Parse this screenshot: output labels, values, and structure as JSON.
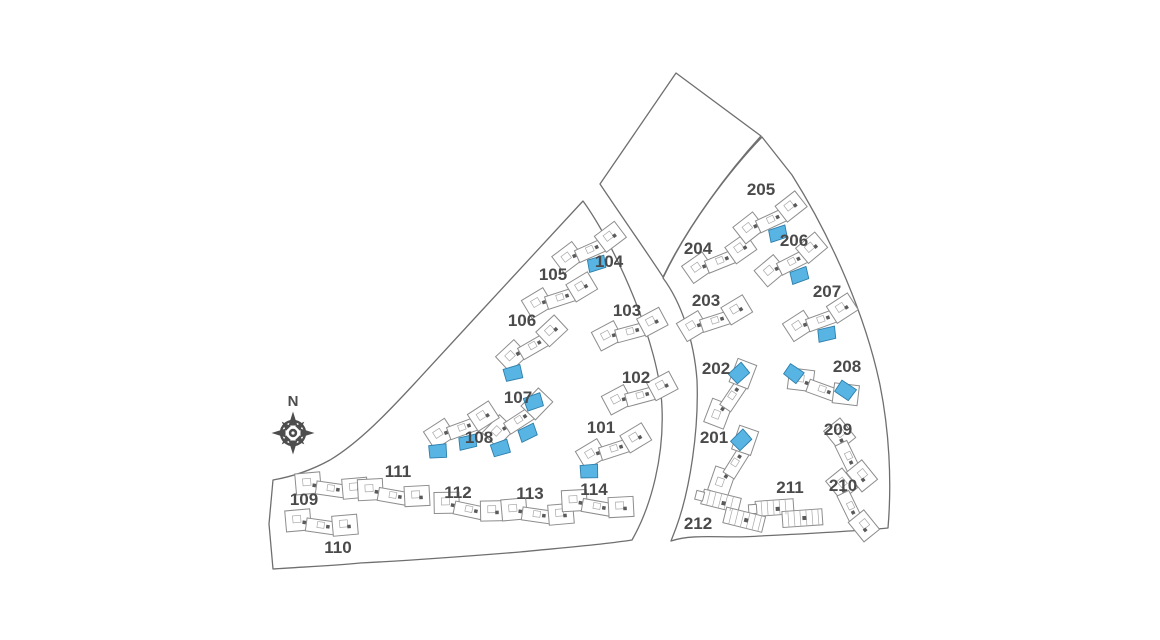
{
  "compass": {
    "label": "N",
    "x": 293,
    "y": 433,
    "label_y": 406
  },
  "colors": {
    "background": "#ffffff",
    "boundary": "#6f6f6f",
    "building_outline": "#8d8d8d",
    "building_fill": "#ffffff",
    "building_detail": "#a8a8a8",
    "building_marker": "#5a5a5a",
    "available_fill": "#57b4e3",
    "available_stroke": "#2f7fab",
    "label": "#4a4a4a",
    "compass": "#4d4d4d"
  },
  "parcels": [
    {
      "name": "west-parcel",
      "path": "M 583,201 C 560,226 470,323 415,383 C 390,410 360,442 330,460 C 310,471 290,477 273,480 L 269,524 L 273,569 C 300,567 330,566 360,563 C 420,560 470,556 520,552 C 560,548 600,545 632,540 C 652,505 664,455 662,408 C 660,345 615,245 583,201 Z"
    },
    {
      "name": "north-parcel",
      "path": "M 600,184 L 676,73 L 761,136 C 730,170 688,225 663,277 C 644,248 620,214 600,184 Z"
    },
    {
      "name": "east-parcel",
      "path": "M 663,278 C 681,302 694,340 697,380 C 699,430 690,490 676,528 L 671,541 C 695,533 725,539 760,536 C 800,534 845,532 888,528 C 892,480 889,430 880,385 C 866,318 833,240 792,175 L 762,137 C 730,170 688,225 663,278 Z"
    }
  ],
  "buildings": [
    {
      "id": "101",
      "x": 615,
      "y": 450,
      "rot": -18,
      "type": "standard",
      "available": [
        "left"
      ],
      "label": {
        "x": 601,
        "y": 427
      }
    },
    {
      "id": "102",
      "x": 641,
      "y": 397,
      "rot": -15,
      "type": "standard",
      "available": [],
      "label": {
        "x": 636,
        "y": 377
      }
    },
    {
      "id": "103",
      "x": 631,
      "y": 333,
      "rot": -15,
      "type": "standard",
      "available": [],
      "label": {
        "x": 627,
        "y": 310
      }
    },
    {
      "id": "104",
      "x": 591,
      "y": 251,
      "rot": -24,
      "type": "standard",
      "available": [
        "center"
      ],
      "label": {
        "x": 609,
        "y": 261
      }
    },
    {
      "id": "105",
      "x": 561,
      "y": 299,
      "rot": -18,
      "type": "standard",
      "available": [],
      "label": {
        "x": 553,
        "y": 274
      }
    },
    {
      "id": "106",
      "x": 534,
      "y": 347,
      "rot": -30,
      "type": "standard",
      "available": [
        "left"
      ],
      "label": {
        "x": 522,
        "y": 320
      }
    },
    {
      "id": "107",
      "x": 520,
      "y": 421,
      "rot": -33,
      "type": "standard",
      "available": [
        "left",
        "center",
        "right"
      ],
      "label": {
        "x": 518,
        "y": 397
      }
    },
    {
      "id": "108",
      "x": 463,
      "y": 429,
      "rot": -20,
      "type": "standard",
      "available": [
        "left",
        "center"
      ],
      "label": {
        "x": 479,
        "y": 437
      }
    },
    {
      "id": "109",
      "x": 331,
      "y": 490,
      "rot": 8,
      "type": "standard",
      "available": [],
      "label": {
        "x": 304,
        "y": 499
      }
    },
    {
      "id": "110",
      "x": 321,
      "y": 527,
      "rot": 8,
      "type": "standard",
      "available": [],
      "label": {
        "x": 338,
        "y": 547
      }
    },
    {
      "id": "111",
      "x": 393,
      "y": 497,
      "rot": 10,
      "type": "standard",
      "available": [],
      "label": {
        "x": 398,
        "y": 471
      }
    },
    {
      "id": "112",
      "x": 469,
      "y": 511,
      "rot": 12,
      "type": "standard",
      "available": [],
      "label": {
        "x": 458,
        "y": 492
      }
    },
    {
      "id": "113",
      "x": 537,
      "y": 516,
      "rot": 8,
      "type": "standard",
      "available": [],
      "label": {
        "x": 530,
        "y": 493
      }
    },
    {
      "id": "114",
      "x": 597,
      "y": 508,
      "rot": 10,
      "type": "standard",
      "available": [],
      "label": {
        "x": 594,
        "y": 489
      }
    },
    {
      "id": "201",
      "x": 737,
      "y": 463,
      "rot": -58,
      "type": "standard",
      "available": [
        "right"
      ],
      "label": {
        "x": 714,
        "y": 437
      }
    },
    {
      "id": "202",
      "x": 734,
      "y": 396,
      "rot": -56,
      "type": "standard",
      "available": [
        "right"
      ],
      "label": {
        "x": 716,
        "y": 368
      }
    },
    {
      "id": "203",
      "x": 716,
      "y": 322,
      "rot": -18,
      "type": "standard",
      "available": [],
      "label": {
        "x": 706,
        "y": 300
      }
    },
    {
      "id": "204",
      "x": 721,
      "y": 262,
      "rot": -22,
      "type": "standard",
      "available": [],
      "label": {
        "x": 698,
        "y": 248
      }
    },
    {
      "id": "205",
      "x": 772,
      "y": 221,
      "rot": -25,
      "type": "standard",
      "available": [
        "center"
      ],
      "label": {
        "x": 761,
        "y": 189
      }
    },
    {
      "id": "206",
      "x": 793,
      "y": 263,
      "rot": -27,
      "type": "standard",
      "available": [
        "center"
      ],
      "label": {
        "x": 794,
        "y": 240
      }
    },
    {
      "id": "207",
      "x": 822,
      "y": 321,
      "rot": -20,
      "type": "standard",
      "available": [
        "center"
      ],
      "label": {
        "x": 827,
        "y": 291
      }
    },
    {
      "id": "208",
      "x": 822,
      "y": 391,
      "rot": 20,
      "type": "standard",
      "available": [
        "lefttop",
        "right"
      ],
      "label": {
        "x": 847,
        "y": 366
      }
    },
    {
      "id": "209",
      "x": 847,
      "y": 457,
      "rot": 64,
      "type": "standard",
      "available": [],
      "label": {
        "x": 838,
        "y": 429
      }
    },
    {
      "id": "210",
      "x": 849,
      "y": 507,
      "rot": 64,
      "type": "standard",
      "available": [],
      "label": {
        "x": 843,
        "y": 485
      }
    },
    {
      "id": "211",
      "x": 790,
      "y": 513,
      "rot": -4,
      "type": "row",
      "available": [],
      "label": {
        "x": 790,
        "y": 487
      }
    },
    {
      "id": "212",
      "x": 734,
      "y": 511,
      "rot": 14,
      "type": "row",
      "available": [],
      "label": {
        "x": 698,
        "y": 523
      }
    }
  ]
}
